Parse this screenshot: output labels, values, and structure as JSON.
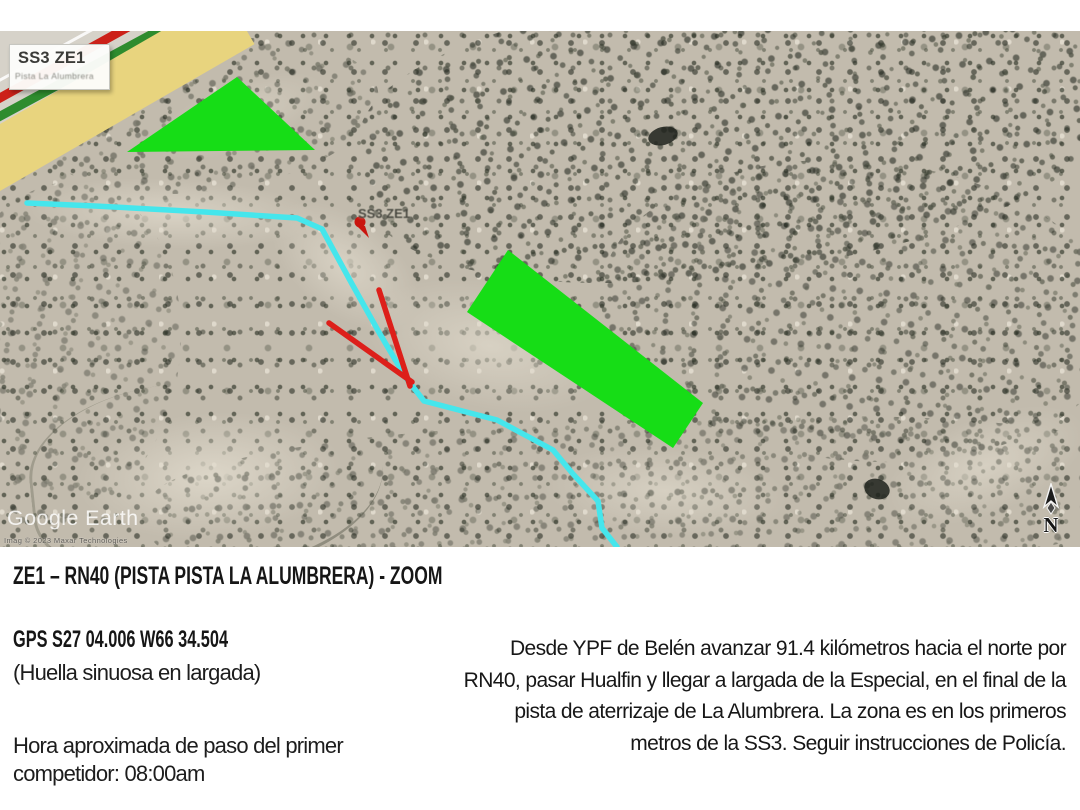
{
  "map": {
    "legend": {
      "title": "SS3 ZE1",
      "subtitle": "Pista La Alumbrera"
    },
    "placemark_label": "SS3 ZE1",
    "watermark": "Google Earth",
    "attribution": "Imag © 2023 Maxar Technologies",
    "north_label": "N",
    "colors": {
      "zone_green": "#16DD16",
      "route_cyan": "#45E6EC",
      "arrow_red": "#DD1F1A",
      "placemark_red": "#C9140E",
      "runway_yellow": "#E8D47E",
      "runway_red": "#CC2018",
      "runway_green": "#2E8C2E"
    }
  },
  "info": {
    "title": "ZE1 – RN40 (PISTA PISTA LA ALUMBRERA) - ZOOM",
    "gps": "GPS S27 04.006 W66 34.504",
    "surface_note": "(Huella sinuosa en largada)",
    "time_lines": [
      "Hora aproximada de paso del primer",
      "competidor: 08:00am"
    ],
    "directions_lines": [
      "Desde YPF de Belén avanzar 91.4 kilómetros hacia el norte por",
      "RN40, pasar Hualfin y llegar a largada de la Especial, en el final de la",
      "pista de aterrizaje de La Alumbrera. La zona es en los primeros",
      "metros de la SS3. Seguir instrucciones de Policía."
    ]
  }
}
